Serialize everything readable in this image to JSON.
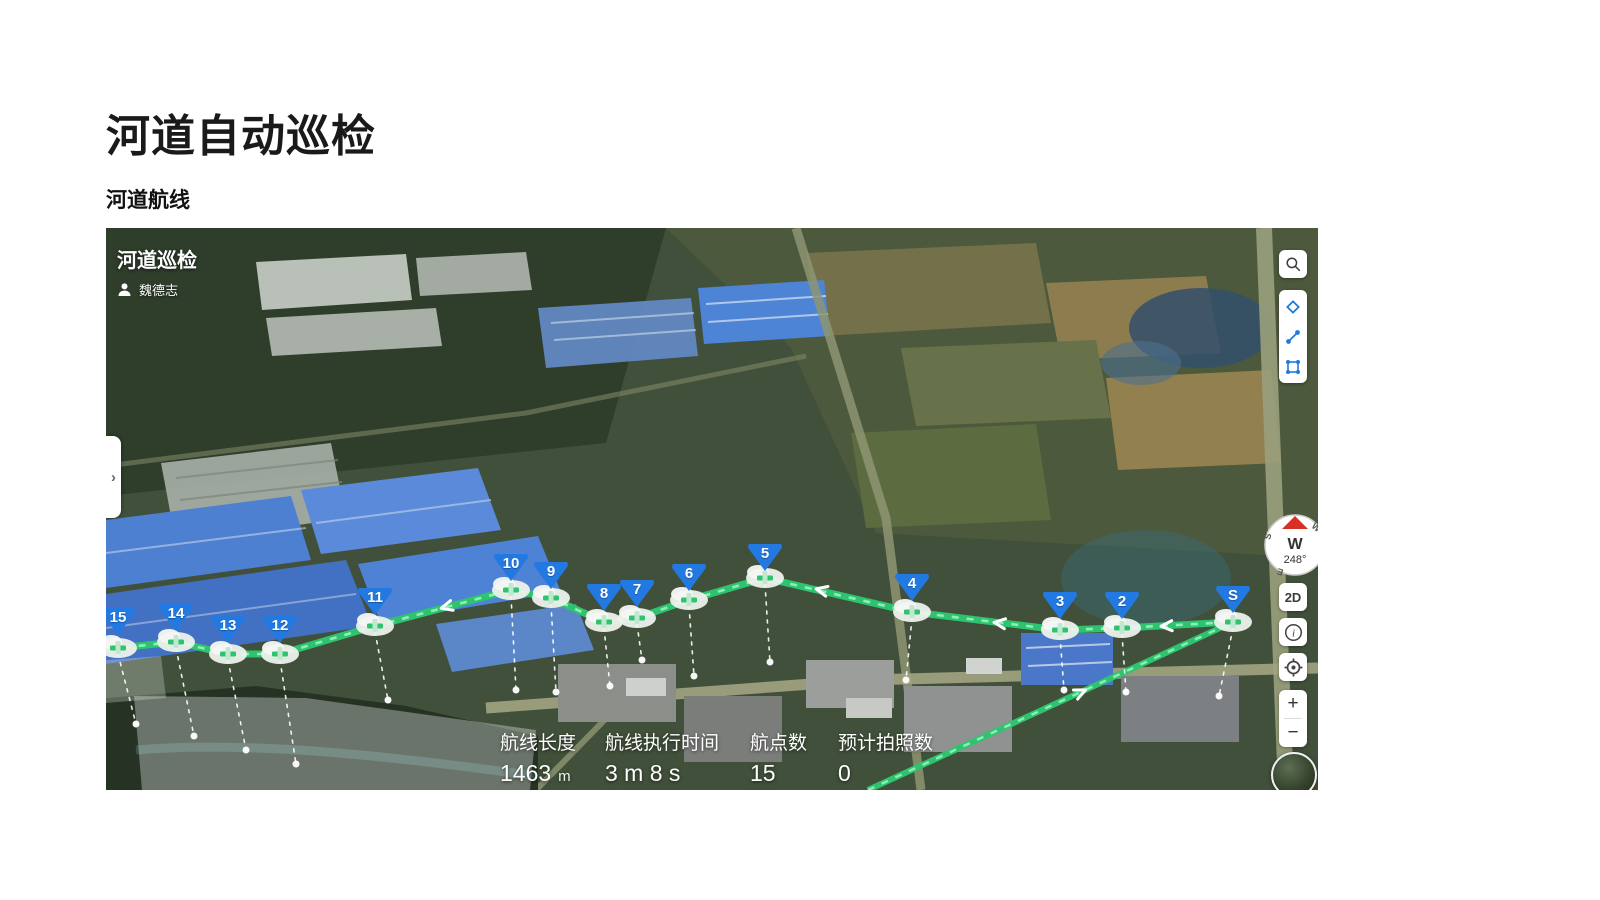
{
  "page": {
    "title": "河道自动巡检",
    "subtitle": "河道航线"
  },
  "map": {
    "panel": {
      "title": "河道巡检",
      "user": "魏德志"
    },
    "stats": [
      {
        "label": "航线长度",
        "value": "1463",
        "unit": "m"
      },
      {
        "label": "航线执行时间",
        "value": "3 m 8 s",
        "unit": ""
      },
      {
        "label": "航点数",
        "value": "15",
        "unit": ""
      },
      {
        "label": "预计拍照数",
        "value": "0",
        "unit": ""
      }
    ],
    "waypoints": [
      {
        "label": "S"
      },
      {
        "label": "2"
      },
      {
        "label": "3"
      },
      {
        "label": "4"
      },
      {
        "label": "5"
      },
      {
        "label": "6"
      },
      {
        "label": "7"
      },
      {
        "label": "8"
      },
      {
        "label": "9"
      },
      {
        "label": "10"
      },
      {
        "label": "11"
      },
      {
        "label": "12"
      },
      {
        "label": "13"
      },
      {
        "label": "14"
      },
      {
        "label": "15"
      }
    ],
    "controls": {
      "sidebar_toggle": "›",
      "view_mode": "2D",
      "zoom_in": "+",
      "zoom_out": "−",
      "compass": {
        "cardinal": "W",
        "heading": "248°",
        "ring": [
          "W",
          "S",
          "E"
        ]
      },
      "icons": {
        "search": "search-icon",
        "diamond": "waypoint-draw-icon",
        "polyline": "polyline-draw-icon",
        "polygon": "polygon-draw-icon",
        "info": "info-icon",
        "locate": "locate-icon",
        "globe": "globe-layer-icon",
        "user": "person-icon"
      }
    },
    "colors": {
      "route_green": "#2ec46f",
      "route_dash": "#8aeeb6",
      "waypoint_blue": "#2379e2"
    }
  }
}
